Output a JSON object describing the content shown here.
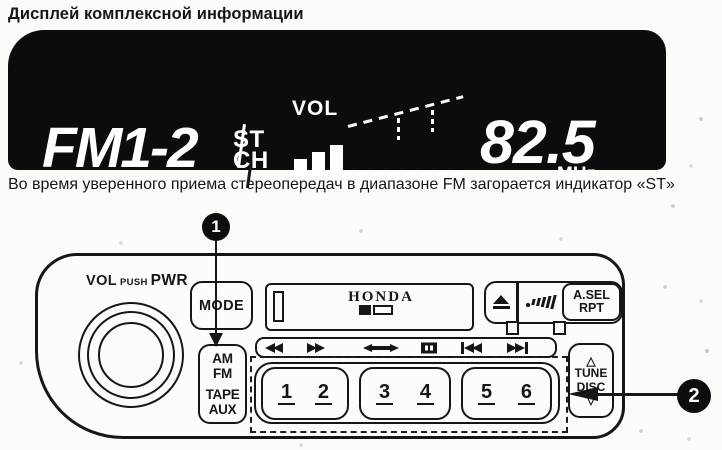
{
  "page": {
    "title": "Дисплей комплексной информации",
    "caption": "Во время уверенного приема стереопередач в диапазоне FM загорается индикатор «ST»"
  },
  "display": {
    "band": "FM1-2",
    "stereo_indicator": "ST",
    "channel_indicator": "CH",
    "volume_label": "VOL",
    "volume_bars_filled": 3,
    "volume_bars_total": 10,
    "frequency": "82.5",
    "frequency_unit": "MHz"
  },
  "unit": {
    "knob": {
      "vol": "VOL",
      "push": "PUSH",
      "pwr": "PWR"
    },
    "mode_label": "MODE",
    "brand": "HONDA",
    "asel_line1": "A.SEL",
    "asel_line2": "RPT",
    "band_line1": "AM",
    "band_line2": "FM",
    "band_line3": "TAPE",
    "band_line4": "AUX",
    "presets": [
      [
        "1",
        "2"
      ],
      [
        "3",
        "4"
      ],
      [
        "5",
        "6"
      ]
    ],
    "tune_line1": "TUNE",
    "tune_line2": "DISC",
    "tune_up_glyph": "△",
    "tune_down_glyph": "▽"
  },
  "callouts": {
    "one": "1",
    "two": "2"
  },
  "icons": {
    "eject": "triangle-over-bar",
    "signal_strength": "rising-bars",
    "rewind": "double-triangle-left",
    "fast_forward": "double-triangle-right",
    "auto_reverse": "double-headed-arrow",
    "dolby": "filled-box-slits",
    "skip_back": "bar-double-triangle-left",
    "skip_forward": "double-triangle-right-bar"
  },
  "colors": {
    "ink": "#161616",
    "display_bg": "#0c0c0c",
    "display_fg": "#ffffff"
  }
}
